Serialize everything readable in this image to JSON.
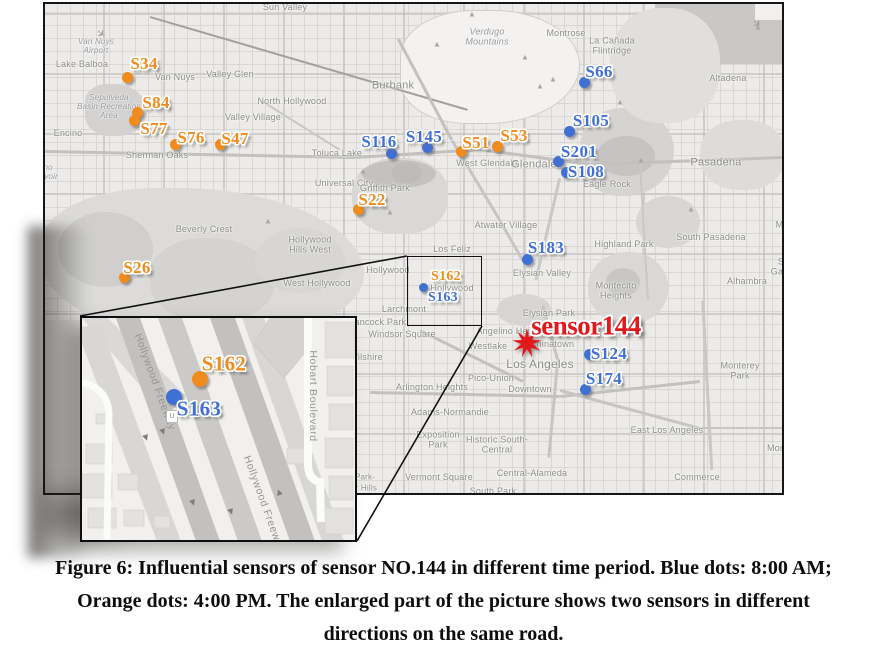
{
  "colors": {
    "blue": "#4170d4",
    "orange": "#f08b1e",
    "red": "#e2191b",
    "map_border": "#161616",
    "place_text": "#8d8c8a"
  },
  "figure": {
    "caption_lines": [
      "Figure 6: Influential sensors of sensor NO.144 in different time period. Blue dots: 8:00 AM;",
      "Orange dots: 4:00 PM. The enlarged part of the picture shows two sensors in different",
      "directions on the same road."
    ]
  },
  "target_sensor": {
    "label": "sensor144",
    "label_x": 586,
    "label_y": 326,
    "star_x": 527,
    "star_y": 343
  },
  "sensors": [
    {
      "id": "S34",
      "color": "orange",
      "dot": [
        127,
        77
      ],
      "label": [
        144,
        64
      ]
    },
    {
      "id": "S84",
      "color": "orange",
      "dot": [
        137,
        112
      ],
      "label": [
        156,
        103
      ]
    },
    {
      "id": "S77",
      "color": "orange",
      "dot": [
        134,
        120
      ],
      "label": [
        154,
        129
      ]
    },
    {
      "id": "S76",
      "color": "orange",
      "dot": [
        175,
        144
      ],
      "label": [
        191,
        138
      ]
    },
    {
      "id": "S47",
      "color": "orange",
      "dot": [
        220,
        144
      ],
      "label": [
        235,
        139
      ]
    },
    {
      "id": "S51",
      "color": "orange",
      "dot": [
        461,
        151
      ],
      "label": [
        476,
        143
      ]
    },
    {
      "id": "S53",
      "color": "orange",
      "dot": [
        497,
        146
      ],
      "label": [
        514,
        136
      ]
    },
    {
      "id": "S22",
      "color": "orange",
      "dot": [
        358,
        209
      ],
      "label": [
        372,
        200
      ]
    },
    {
      "id": "S26",
      "color": "orange",
      "dot": [
        124,
        277
      ],
      "label": [
        137,
        268
      ]
    },
    {
      "id": "S66",
      "color": "blue",
      "dot": [
        584,
        82
      ],
      "label": [
        599,
        72
      ]
    },
    {
      "id": "S105",
      "color": "blue",
      "dot": [
        569,
        131
      ],
      "label": [
        591,
        121
      ]
    },
    {
      "id": "S201",
      "color": "blue",
      "dot": [
        558,
        161
      ],
      "label": [
        579,
        152
      ]
    },
    {
      "id": "S108",
      "color": "blue",
      "dot": [
        566,
        172
      ],
      "label": [
        586,
        172
      ]
    },
    {
      "id": "S116",
      "color": "blue",
      "dot": [
        391,
        153
      ],
      "label": [
        379,
        142
      ]
    },
    {
      "id": "S145",
      "color": "blue",
      "dot": [
        427,
        147
      ],
      "label": [
        424,
        137
      ]
    },
    {
      "id": "S183",
      "color": "blue",
      "dot": [
        527,
        259
      ],
      "label": [
        546,
        248
      ]
    },
    {
      "id": "S124",
      "color": "blue",
      "dot": [
        589,
        354
      ],
      "label": [
        609,
        354
      ]
    },
    {
      "id": "S174",
      "color": "blue",
      "dot": [
        585,
        389
      ],
      "label": [
        604,
        379
      ]
    }
  ],
  "callout": {
    "box": {
      "x": 407,
      "y": 256,
      "w": 75,
      "h": 70,
      "labels": [
        {
          "id": "S162",
          "color": "orange",
          "pos": [
            446,
            277
          ]
        },
        {
          "id": "S163",
          "color": "blue",
          "pos": [
            443,
            298
          ]
        }
      ],
      "dot": {
        "color": "blue",
        "pos": [
          423,
          287
        ]
      }
    },
    "lines": [
      [
        407,
        256,
        80,
        316
      ],
      [
        482,
        326,
        357,
        541
      ]
    ],
    "inset": {
      "x": 80,
      "y": 316,
      "w": 277,
      "h": 226,
      "sensors": [
        {
          "id": "S162",
          "color": "orange",
          "dot": [
            118,
            61
          ],
          "label": [
            142,
            46
          ]
        },
        {
          "id": "S163",
          "color": "blue",
          "dot": [
            92,
            79
          ],
          "label": [
            117,
            91
          ]
        }
      ],
      "road_labels": [
        "Hollywood Freeway",
        "Hollywood Freeway",
        "Hobart Boulevard"
      ],
      "shield_letter": "U"
    }
  },
  "map": {
    "places": [
      {
        "t": "Sun Valley",
        "x": 285,
        "y": 7
      },
      {
        "t": "Lake Balboa",
        "x": 82,
        "y": 64
      },
      {
        "t": "Van Nuys\nAirport",
        "x": 96,
        "y": 46,
        "s": 8,
        "i": 1
      },
      {
        "t": "Van Nuys",
        "x": 175,
        "y": 77
      },
      {
        "t": "Valley Glen",
        "x": 230,
        "y": 74
      },
      {
        "t": "North Hollywood",
        "x": 292,
        "y": 101
      },
      {
        "t": "Valley Village",
        "x": 253,
        "y": 117
      },
      {
        "t": "Encino",
        "x": 68,
        "y": 133
      },
      {
        "t": "Sherman Oaks",
        "x": 157,
        "y": 155
      },
      {
        "t": "Sepulveda\nBasin Recreation\nArea",
        "x": 109,
        "y": 107,
        "s": 8,
        "i": 1
      },
      {
        "t": "Encino\nReservoir",
        "x": 40,
        "y": 172,
        "s": 8,
        "i": 1
      },
      {
        "t": "Toluca Lake",
        "x": 337,
        "y": 153
      },
      {
        "t": "Universal City",
        "x": 344,
        "y": 183
      },
      {
        "t": "Burbank",
        "x": 393,
        "y": 86,
        "s": 11
      },
      {
        "t": "Verdugo\nMountains",
        "x": 487,
        "y": 37,
        "i": 1
      },
      {
        "t": "Montrose",
        "x": 566,
        "y": 33
      },
      {
        "t": "La Cañada\nFlintridge",
        "x": 612,
        "y": 46
      },
      {
        "t": "Altadena",
        "x": 728,
        "y": 78
      },
      {
        "t": "Pasadena",
        "x": 716,
        "y": 163,
        "s": 11
      },
      {
        "t": "Griffith Park",
        "x": 385,
        "y": 188
      },
      {
        "t": "West Glendale",
        "x": 487,
        "y": 163
      },
      {
        "t": "Glendale",
        "x": 534,
        "y": 165,
        "s": 11
      },
      {
        "t": "Eagle Rock",
        "x": 607,
        "y": 184
      },
      {
        "t": "Atwater Village",
        "x": 506,
        "y": 225
      },
      {
        "t": "Los Feliz",
        "x": 452,
        "y": 249
      },
      {
        "t": "Highland Park",
        "x": 624,
        "y": 244
      },
      {
        "t": "South Pasadena",
        "x": 711,
        "y": 237
      },
      {
        "t": "San Marino",
        "x": 790,
        "y": 220
      },
      {
        "t": "San Gabriel",
        "x": 786,
        "y": 267
      },
      {
        "t": "Alhambra",
        "x": 747,
        "y": 281
      },
      {
        "t": "Montecito\nHeights",
        "x": 616,
        "y": 291
      },
      {
        "t": "Elysian Valley",
        "x": 542,
        "y": 273
      },
      {
        "t": "Beverly Crest",
        "x": 204,
        "y": 229
      },
      {
        "t": "Hollywood\nHills West",
        "x": 310,
        "y": 245
      },
      {
        "t": "West Hollywood",
        "x": 317,
        "y": 283
      },
      {
        "t": "Hollywood",
        "x": 388,
        "y": 270
      },
      {
        "t": "Hollywood",
        "x": 452,
        "y": 288
      },
      {
        "t": "Larchmont",
        "x": 404,
        "y": 309
      },
      {
        "t": "Hancock Park",
        "x": 377,
        "y": 322
      },
      {
        "t": "Windsor Square",
        "x": 402,
        "y": 334
      },
      {
        "t": "Wilshire",
        "x": 366,
        "y": 357
      },
      {
        "t": "Westlake",
        "x": 488,
        "y": 346
      },
      {
        "t": "Angelino Heights",
        "x": 512,
        "y": 331
      },
      {
        "t": "Elysian Park",
        "x": 549,
        "y": 313
      },
      {
        "t": "Chinatown",
        "x": 552,
        "y": 344
      },
      {
        "t": "Los Angeles",
        "x": 540,
        "y": 365,
        "s": 12
      },
      {
        "t": "Downtown",
        "x": 530,
        "y": 389
      },
      {
        "t": "Pico-Union",
        "x": 491,
        "y": 378
      },
      {
        "t": "Arlington Heights",
        "x": 432,
        "y": 387
      },
      {
        "t": "Adams-Normandie",
        "x": 450,
        "y": 412
      },
      {
        "t": "Exposition\nPark",
        "x": 438,
        "y": 440
      },
      {
        "t": "Historic South-\nCentral",
        "x": 497,
        "y": 445
      },
      {
        "t": "Vermont Square",
        "x": 439,
        "y": 477
      },
      {
        "t": "South Park",
        "x": 493,
        "y": 491
      },
      {
        "t": "Central-Alameda",
        "x": 532,
        "y": 473
      },
      {
        "t": "East Los Angeles",
        "x": 667,
        "y": 430
      },
      {
        "t": "Commerce",
        "x": 697,
        "y": 477
      },
      {
        "t": "Montebello",
        "x": 790,
        "y": 448
      },
      {
        "t": "Monterey Park",
        "x": 740,
        "y": 371
      },
      {
        "t": "Park-",
        "x": 365,
        "y": 477,
        "s": 8
      },
      {
        "t": "or Hills",
        "x": 364,
        "y": 488,
        "s": 8
      }
    ],
    "peaks": [
      [
        472,
        14
      ],
      [
        437,
        44
      ],
      [
        525,
        57
      ],
      [
        553,
        79
      ],
      [
        620,
        102
      ],
      [
        758,
        27
      ],
      [
        363,
        171
      ],
      [
        390,
        212
      ],
      [
        691,
        209
      ],
      [
        641,
        160
      ],
      [
        268,
        221
      ],
      [
        540,
        86
      ]
    ],
    "planes": [
      [
        101,
        34
      ],
      [
        757,
        24
      ]
    ]
  }
}
